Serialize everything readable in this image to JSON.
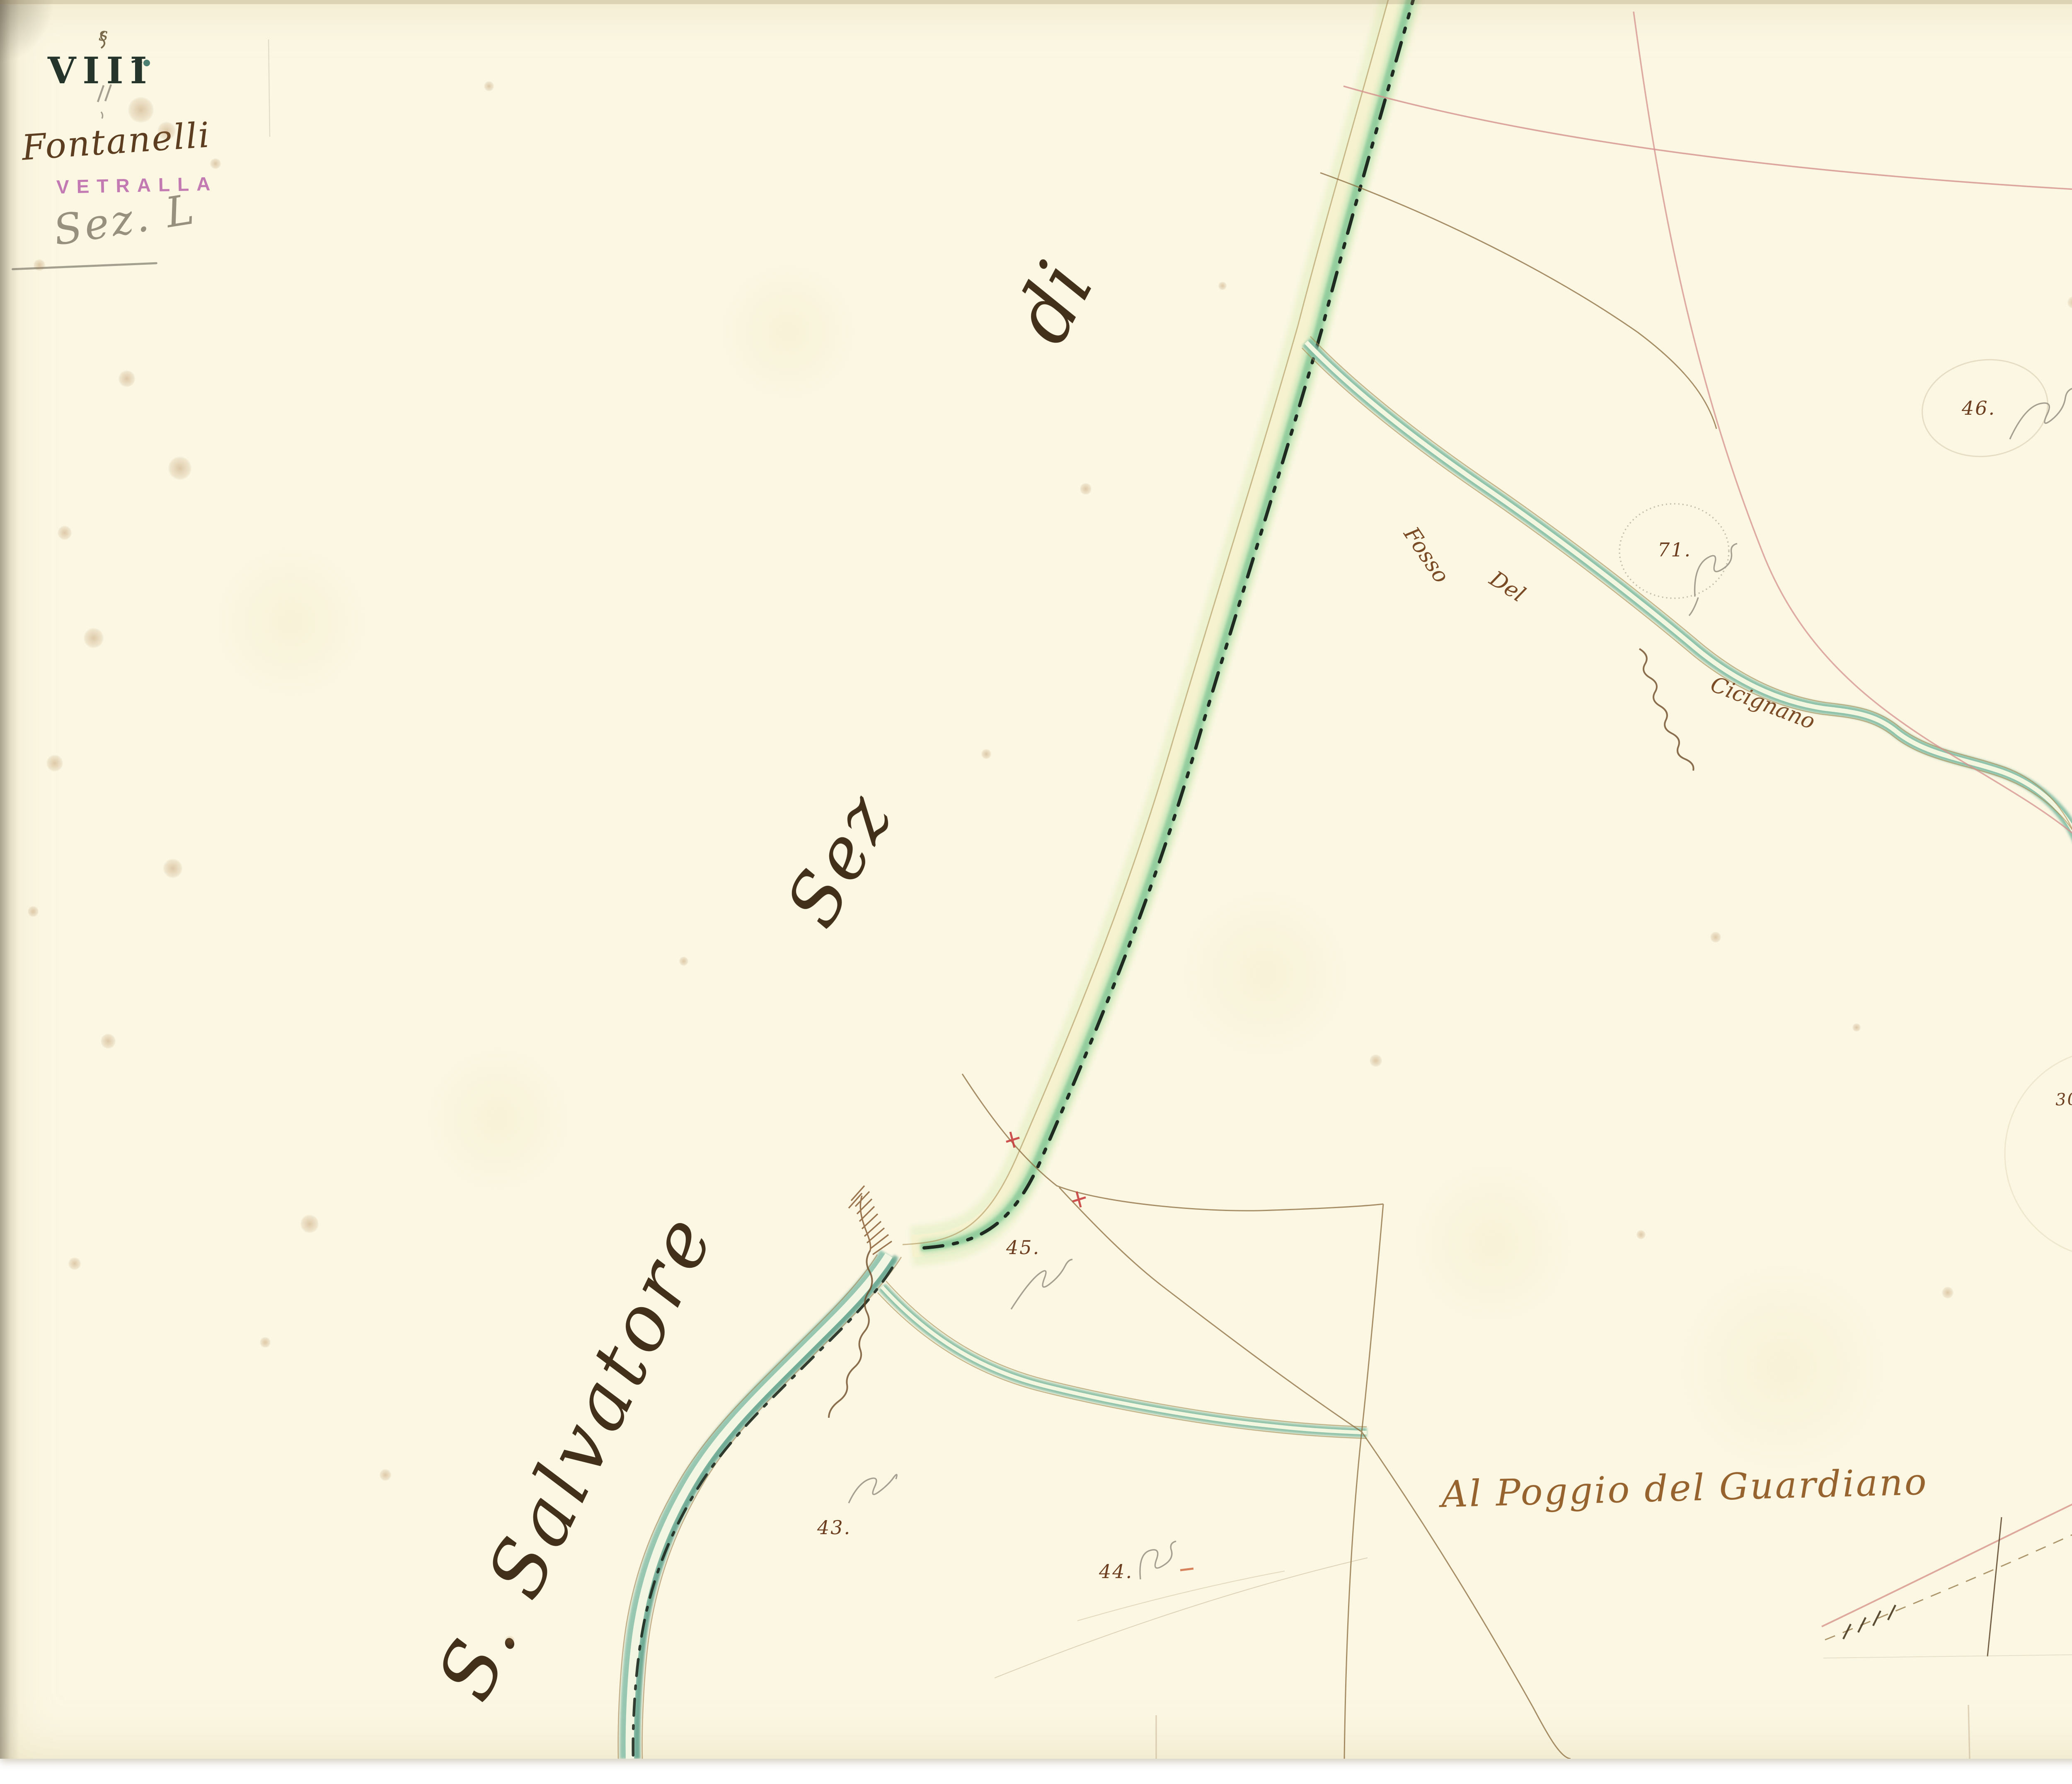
{
  "sheet": {
    "corner_mark": "s",
    "plate_number": "VIII",
    "plate_pencil_number": "11",
    "area_name": "Fontanelli",
    "stamp_text": "VETRALLA",
    "pencil_note": "Sez. L"
  },
  "labels": {
    "road_label_top": "di",
    "road_label_mid": "Sez",
    "river_name": "S. Salvatore",
    "stream_word_1": "Fosso",
    "stream_word_2": "Del",
    "stream_word_3": "Cicignano",
    "locality": "Al Poggio del Guardiano"
  },
  "parcels": [
    {
      "number": "46."
    },
    {
      "number": "71."
    },
    {
      "number": "30 Subº 2."
    },
    {
      "number": "45."
    },
    {
      "number": "43."
    },
    {
      "number": "44."
    }
  ],
  "colors": {
    "paper": "#fbf7e3",
    "road_green": "#8fcb9b",
    "river_teal": "#8fc3ad",
    "ink_brown": "#6d3d1f",
    "ink_dark": "#43301b",
    "stamp_purple": "#b55aa5",
    "boundary_pink": "#d4908c",
    "pencil_gray": "#8f897b",
    "dashline_black": "#1f2a20"
  }
}
